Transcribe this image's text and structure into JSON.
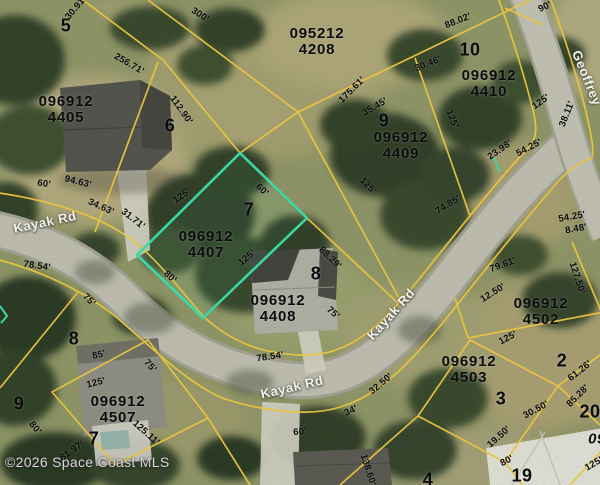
{
  "map": {
    "copyright": "©2026 Space Coast MLS",
    "highlighted_parcel": "096912 4407",
    "colors": {
      "parcel_line": "#e9c53f",
      "highlight": "#3bd8a6",
      "road": "#c3c1b5"
    },
    "road_names": [
      "Kayak Rd",
      "Geoffrey"
    ],
    "road_labels": [
      {
        "t": "Kayak Rd",
        "x": 45,
        "y": 222,
        "r": -12
      },
      {
        "t": "Kayak Rd",
        "x": 292,
        "y": 387,
        "r": -13
      },
      {
        "t": "Kayak Rd",
        "x": 391,
        "y": 314,
        "r": -48
      },
      {
        "t": "Geoffrey",
        "x": 587,
        "y": 78,
        "r": 68
      }
    ],
    "parcels": [
      {
        "id1": "096912",
        "id2": "4405",
        "x": 66,
        "y": 110
      },
      {
        "id1": "095212",
        "id2": "4208",
        "x": 317,
        "y": 42
      },
      {
        "id1": "096912",
        "id2": "4410",
        "x": 489,
        "y": 84
      },
      {
        "id1": "096912",
        "id2": "4409",
        "x": 401,
        "y": 146
      },
      {
        "id1": "096912",
        "id2": "4407",
        "x": 206,
        "y": 245,
        "hl": true
      },
      {
        "id1": "096912",
        "id2": "4408",
        "x": 278,
        "y": 309
      },
      {
        "id1": "096912",
        "id2": "4502",
        "x": 541,
        "y": 312
      },
      {
        "id1": "096912",
        "id2": "4503",
        "x": 469,
        "y": 370
      },
      {
        "id1": "096912",
        "id2": "4507",
        "x": 118,
        "y": 410
      }
    ],
    "lot_numbers": [
      {
        "t": "5",
        "x": 66,
        "y": 26
      },
      {
        "t": "6",
        "x": 170,
        "y": 126
      },
      {
        "t": "10",
        "x": 470,
        "y": 50
      },
      {
        "t": "9",
        "x": 384,
        "y": 121
      },
      {
        "t": "7",
        "x": 249,
        "y": 210
      },
      {
        "t": "8",
        "x": 316,
        "y": 274
      },
      {
        "t": "2",
        "x": 562,
        "y": 361
      },
      {
        "t": "3",
        "x": 501,
        "y": 399
      },
      {
        "t": "20",
        "x": 590,
        "y": 412
      },
      {
        "t": "19",
        "x": 522,
        "y": 476
      },
      {
        "t": "4",
        "x": 428,
        "y": 480
      },
      {
        "t": "8",
        "x": 74,
        "y": 339
      },
      {
        "t": "9",
        "x": 19,
        "y": 404
      },
      {
        "t": "7",
        "x": 94,
        "y": 439
      },
      {
        "t": "09",
        "x": 597,
        "y": 439,
        "it": 1
      }
    ],
    "measurements": [
      {
        "t": "30.91'",
        "x": 76,
        "y": 8,
        "r": -50
      },
      {
        "t": "300'",
        "x": 200,
        "y": 15,
        "r": 33
      },
      {
        "t": "256.71'",
        "x": 129,
        "y": 64,
        "r": 30
      },
      {
        "t": "112.90'",
        "x": 181,
        "y": 110,
        "r": 55
      },
      {
        "t": "88.02'",
        "x": 458,
        "y": 21,
        "r": -22
      },
      {
        "t": "30.46'",
        "x": 428,
        "y": 64,
        "r": -22
      },
      {
        "t": "90'",
        "x": 545,
        "y": 7,
        "r": -25
      },
      {
        "t": "175.61'",
        "x": 352,
        "y": 90,
        "r": -45
      },
      {
        "t": "35.45'",
        "x": 375,
        "y": 107,
        "r": -30
      },
      {
        "t": "125'",
        "x": 452,
        "y": 119,
        "r": 68
      },
      {
        "t": "125'",
        "x": 541,
        "y": 102,
        "r": -35
      },
      {
        "t": "38.11'",
        "x": 567,
        "y": 114,
        "r": -68
      },
      {
        "t": "23.98'",
        "x": 500,
        "y": 150,
        "r": -35
      },
      {
        "t": "54.25'",
        "x": 529,
        "y": 148,
        "r": -28
      },
      {
        "t": "125'",
        "x": 368,
        "y": 186,
        "r": 45
      },
      {
        "t": "125'",
        "x": 182,
        "y": 196,
        "r": -35
      },
      {
        "t": "60'",
        "x": 262,
        "y": 190,
        "r": 42
      },
      {
        "t": "125'",
        "x": 247,
        "y": 258,
        "r": -40
      },
      {
        "t": "80'",
        "x": 170,
        "y": 277,
        "r": 42
      },
      {
        "t": "88.29'",
        "x": 330,
        "y": 258,
        "r": 44
      },
      {
        "t": "75'",
        "x": 333,
        "y": 313,
        "r": 42
      },
      {
        "t": "60'",
        "x": 44,
        "y": 184,
        "r": 8
      },
      {
        "t": "94.63'",
        "x": 78,
        "y": 182,
        "r": 14
      },
      {
        "t": "34.63'",
        "x": 101,
        "y": 207,
        "r": 24
      },
      {
        "t": "31.71'",
        "x": 133,
        "y": 219,
        "r": 38
      },
      {
        "t": "78.54'",
        "x": 37,
        "y": 266,
        "r": 8
      },
      {
        "t": "75'",
        "x": 89,
        "y": 300,
        "r": 45
      },
      {
        "t": "74.85'",
        "x": 448,
        "y": 205,
        "r": -32
      },
      {
        "t": "54.25'",
        "x": 572,
        "y": 217,
        "r": -10
      },
      {
        "t": "8.48'",
        "x": 576,
        "y": 229,
        "r": -10
      },
      {
        "t": "79.61'",
        "x": 503,
        "y": 265,
        "r": -20
      },
      {
        "t": "12.50'",
        "x": 493,
        "y": 293,
        "r": -32
      },
      {
        "t": "127.50'",
        "x": 577,
        "y": 278,
        "r": 72
      },
      {
        "t": "125'",
        "x": 508,
        "y": 338,
        "r": -28
      },
      {
        "t": "61.26'",
        "x": 580,
        "y": 371,
        "r": -38
      },
      {
        "t": "85.28'",
        "x": 578,
        "y": 396,
        "r": -45
      },
      {
        "t": "30.50'",
        "x": 536,
        "y": 410,
        "r": -28
      },
      {
        "t": "19.50'",
        "x": 499,
        "y": 437,
        "r": -42
      },
      {
        "t": "80'",
        "x": 507,
        "y": 461,
        "r": -28
      },
      {
        "t": "125'",
        "x": 594,
        "y": 464,
        "r": -30
      },
      {
        "t": "138.60'",
        "x": 368,
        "y": 470,
        "r": 72
      },
      {
        "t": "32.50'",
        "x": 381,
        "y": 384,
        "r": -40
      },
      {
        "t": "34'",
        "x": 351,
        "y": 411,
        "r": -24
      },
      {
        "t": "60'",
        "x": 300,
        "y": 432,
        "r": -5
      },
      {
        "t": "78.54'",
        "x": 270,
        "y": 357,
        "r": -8
      },
      {
        "t": "85'",
        "x": 99,
        "y": 355,
        "r": -12
      },
      {
        "t": "75'",
        "x": 150,
        "y": 366,
        "r": 48
      },
      {
        "t": "125'",
        "x": 96,
        "y": 383,
        "r": -14
      },
      {
        "t": "80'",
        "x": 35,
        "y": 428,
        "r": 50
      },
      {
        "t": "81.97'",
        "x": 72,
        "y": 451,
        "r": -35
      },
      {
        "t": "125.11'",
        "x": 146,
        "y": 433,
        "r": 42
      }
    ]
  }
}
